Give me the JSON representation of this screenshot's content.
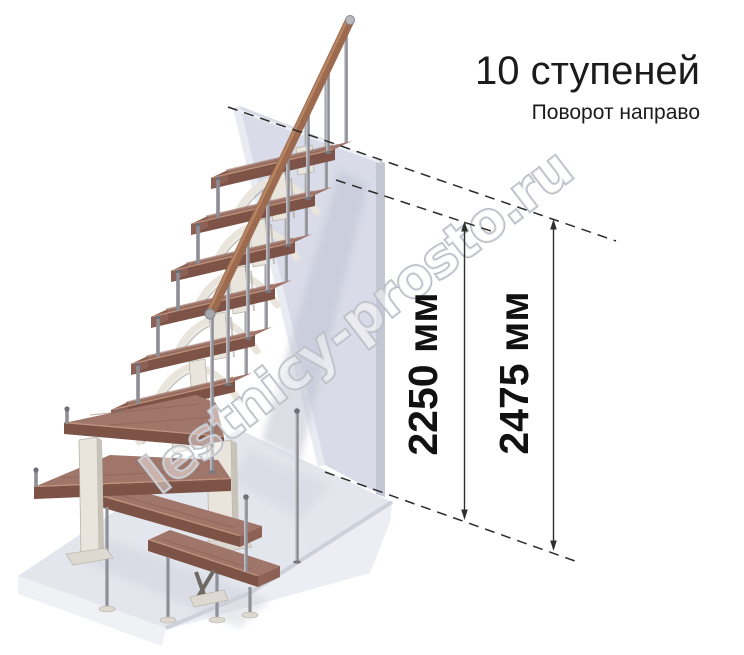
{
  "title": {
    "heading": "10 ступеней",
    "subheading": "Поворот направо",
    "steps": 10,
    "turn": "направо"
  },
  "dimensions": {
    "stair_height": "2250 мм",
    "total_height": "2475 мм"
  },
  "watermark": {
    "text": "lestnicy-prosto.ru"
  },
  "colors": {
    "wood_top": "#a0766a",
    "wood_front": "#7d5348",
    "wood_side": "#8d6156",
    "metal": "#8d8d95",
    "module_cream": "#e9e5dc",
    "wall_front": "#d9dce8",
    "wall_left": "#e9ebf2",
    "wall_right": "#c3c6d3",
    "floor_top": "#e4e6ed",
    "annotation": "#2b2b2b"
  }
}
